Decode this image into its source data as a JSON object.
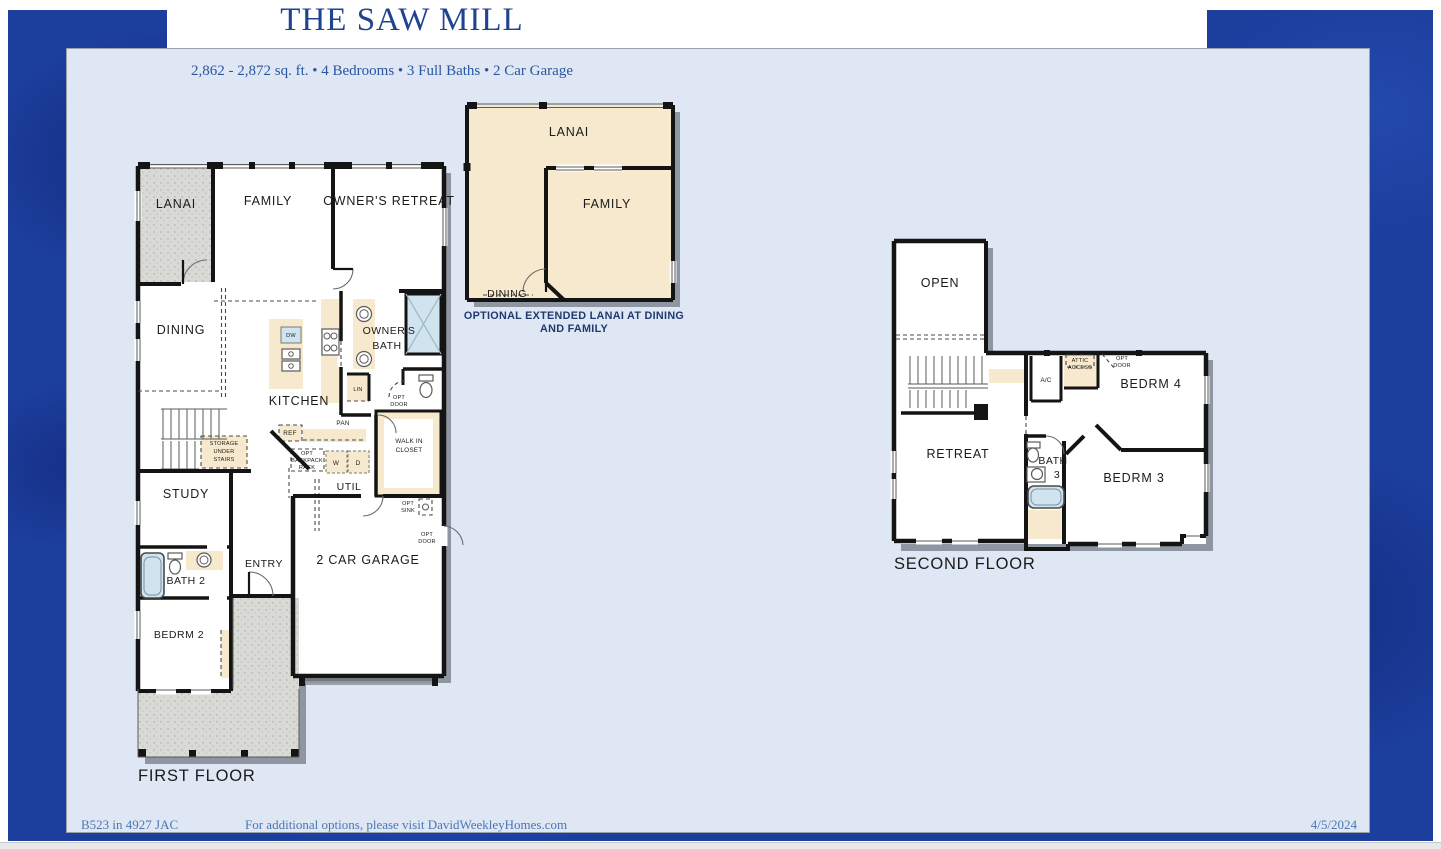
{
  "header": {
    "title": "THE SAW MILL",
    "subtitle": "2,862 - 2,872 sq. ft. • 4 Bedrooms • 3 Full Baths • 2 Car Garage"
  },
  "first_floor": {
    "caption": "FIRST FLOOR",
    "labels": {
      "lanai": "LANAI",
      "family": "FAMILY",
      "owners_retreat": "OWNER'S RETREAT",
      "dining": "DINING",
      "kitchen": "KITCHEN",
      "owners_bath_line1": "OWNER'S",
      "owners_bath_line2": "BATH",
      "dw": "DW",
      "lin": "LIN",
      "opt_door_line1": "OPT",
      "opt_door_line2": "DOOR",
      "ref": "REF",
      "pan": "PAN",
      "storage_line1": "STORAGE",
      "storage_line2": "UNDER",
      "storage_line3": "STAIRS",
      "opt_backpack_line1": "OPT",
      "opt_backpack_line2": "BACKPACK",
      "opt_backpack_line3": "RACK",
      "washer": "W",
      "dryer": "D",
      "util": "UTIL",
      "walk_in_line1": "WALK IN",
      "walk_in_line2": "CLOSET",
      "study": "STUDY",
      "bath2": "BATH 2",
      "bedrm2": "BEDRM 2",
      "entry": "ENTRY",
      "garage": "2 CAR GARAGE",
      "opt_sink_line1": "OPT",
      "opt_sink_line2": "SINK",
      "garage_opt_door_line1": "OPT",
      "garage_opt_door_line2": "DOOR"
    }
  },
  "option_detail": {
    "labels": {
      "lanai": "LANAI",
      "family": "FAMILY",
      "dining": "DINING"
    },
    "caption_line1": "OPTIONAL EXTENDED LANAI AT DINING",
    "caption_line2": "AND FAMILY"
  },
  "second_floor": {
    "caption": "SECOND FLOOR",
    "labels": {
      "open": "OPEN",
      "retreat": "RETREAT",
      "ac": "A/C",
      "attic_line1": "ATTIC",
      "attic_line2": "ACCESS",
      "opt_door_line1": "OPT",
      "opt_door_line2": "DOOR",
      "bedrm4": "BEDRM 4",
      "bath3_line1": "BATH",
      "bath3_line2": "3",
      "bedrm3": "BEDRM 3"
    }
  },
  "footer": {
    "left": "B523 in 4927 JAC",
    "center": "For additional options, please visit DavidWeekleyHomes.com",
    "right": "4/5/2024"
  },
  "colors": {
    "frame_blue": "#1c3e9d",
    "panel_bg": "#dfe7f4",
    "title_blue": "#1f4390",
    "cream": "#f7e9cd",
    "tile_blue": "#cfe4ef",
    "porch_gray": "#d9d9d6",
    "shadow_gray": "#8e96a2"
  }
}
